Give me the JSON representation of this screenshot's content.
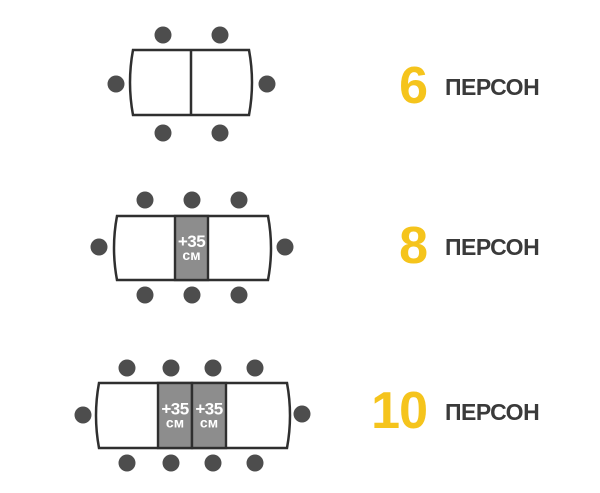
{
  "colors": {
    "background": "#ffffff",
    "chair": "#4d4d4d",
    "table_border": "#2f2f2f",
    "table_fill": "#ffffff",
    "extension_fill": "#8d8d8d",
    "extension_text": "#ffffff",
    "count_number": "#f5c41c",
    "count_word": "#3a3a3a"
  },
  "rows": [
    {
      "persons": "6",
      "persons_label": "ПЕРСОН",
      "seats": {
        "top": 2,
        "bottom": 2,
        "left": 1,
        "right": 1,
        "total": 6
      },
      "extensions": [],
      "geometry": {
        "table": {
          "x": 133,
          "y": 50,
          "w": 116,
          "h": 65
        },
        "dividers": [
          191
        ],
        "ext_rects": [],
        "chair_r": 8.5,
        "chairs": {
          "top_xs": [
            163,
            220
          ],
          "top_y": 35,
          "bottom_xs": [
            163,
            220
          ],
          "bottom_y": 133,
          "left": [
            116,
            84
          ],
          "right": [
            267,
            84
          ]
        },
        "label_center_y": 86
      }
    },
    {
      "persons": "8",
      "persons_label": "ПЕРСОН",
      "seats": {
        "top": 3,
        "bottom": 3,
        "left": 1,
        "right": 1,
        "total": 8
      },
      "extensions": [
        {
          "line1": "+35",
          "line2": "см"
        }
      ],
      "geometry": {
        "table": {
          "x": 117,
          "y": 216,
          "w": 151,
          "h": 64
        },
        "dividers": [],
        "ext_rects": [
          {
            "x": 175,
            "w": 33
          }
        ],
        "chair_r": 8.5,
        "chairs": {
          "top_xs": [
            145,
            192,
            239
          ],
          "top_y": 200,
          "bottom_xs": [
            145,
            192,
            239
          ],
          "bottom_y": 295,
          "left": [
            99,
            247
          ],
          "right": [
            285,
            247
          ]
        },
        "label_center_y": 246
      }
    },
    {
      "persons": "10",
      "persons_label": "ПЕРСОН",
      "seats": {
        "top": 4,
        "bottom": 4,
        "left": 1,
        "right": 1,
        "total": 10
      },
      "extensions": [
        {
          "line1": "+35",
          "line2": "см"
        },
        {
          "line1": "+35",
          "line2": "см"
        }
      ],
      "geometry": {
        "table": {
          "x": 99,
          "y": 383,
          "w": 188,
          "h": 65
        },
        "dividers": [],
        "ext_rects": [
          {
            "x": 158,
            "w": 34
          },
          {
            "x": 192,
            "w": 34
          }
        ],
        "chair_r": 8.5,
        "chairs": {
          "top_xs": [
            127,
            171,
            213,
            255
          ],
          "top_y": 368,
          "bottom_xs": [
            127,
            171,
            213,
            255
          ],
          "bottom_y": 463,
          "left": [
            83,
            415
          ],
          "right": [
            302,
            414
          ]
        },
        "label_center_y": 411
      }
    }
  ]
}
